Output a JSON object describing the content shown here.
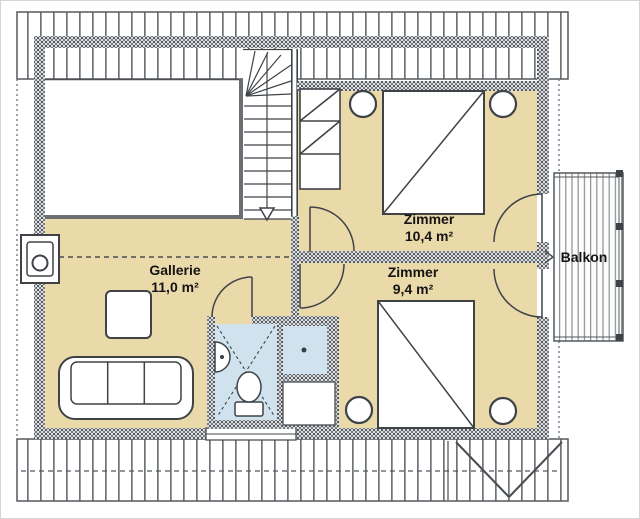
{
  "floor_plan": {
    "rooms": {
      "gallerie": {
        "label": "Gallerie",
        "area": "11,0 m²"
      },
      "zimmer_top": {
        "label": "Zimmer",
        "area": "10,4 m²"
      },
      "zimmer_bottom": {
        "label": "Zimmer",
        "area": "9,4 m²"
      },
      "balkon": {
        "label": "Balkon"
      }
    },
    "colors": {
      "floor": "#ead9a9",
      "bathroom_floor": "#cfe2ee",
      "wall_dot": "#4a4e53",
      "line": "#3f4347",
      "roof_hatch": "#6e7377"
    }
  }
}
